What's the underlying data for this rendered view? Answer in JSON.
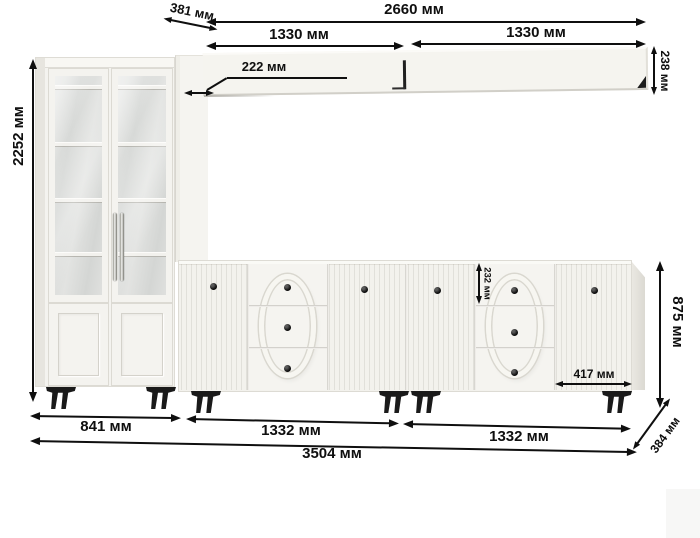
{
  "meta": {
    "title": "furniture wall-unit dimension diagram",
    "unit": "мм"
  },
  "colors": {
    "background": "#ffffff",
    "annotation": "#0f0f0f",
    "furniture": "#f3f2ed",
    "furniture_shadow": "#e3e1da",
    "glass": "#dcdedc",
    "leg": "#1a1a1a",
    "knob": "#0c0c0c",
    "handle_chrome": "#c9c9c7"
  },
  "dimensions": {
    "total_height": "2252 мм",
    "top_depth": "381 мм",
    "shelf_total_width": "2660 мм",
    "shelf_left_width": "1330 мм",
    "shelf_right_width": "1330 мм",
    "shelf_depth": "222 мм",
    "shelf_height": "238 мм",
    "drawer_height": "232 мм",
    "right_door_width": "417 мм",
    "sideboard_height": "875 мм",
    "cabinet_width": "841 мм",
    "sideboard_left_width": "1332 мм",
    "sideboard_right_width": "1332 мм",
    "total_width": "3504 мм",
    "bottom_depth": "384 мм"
  }
}
